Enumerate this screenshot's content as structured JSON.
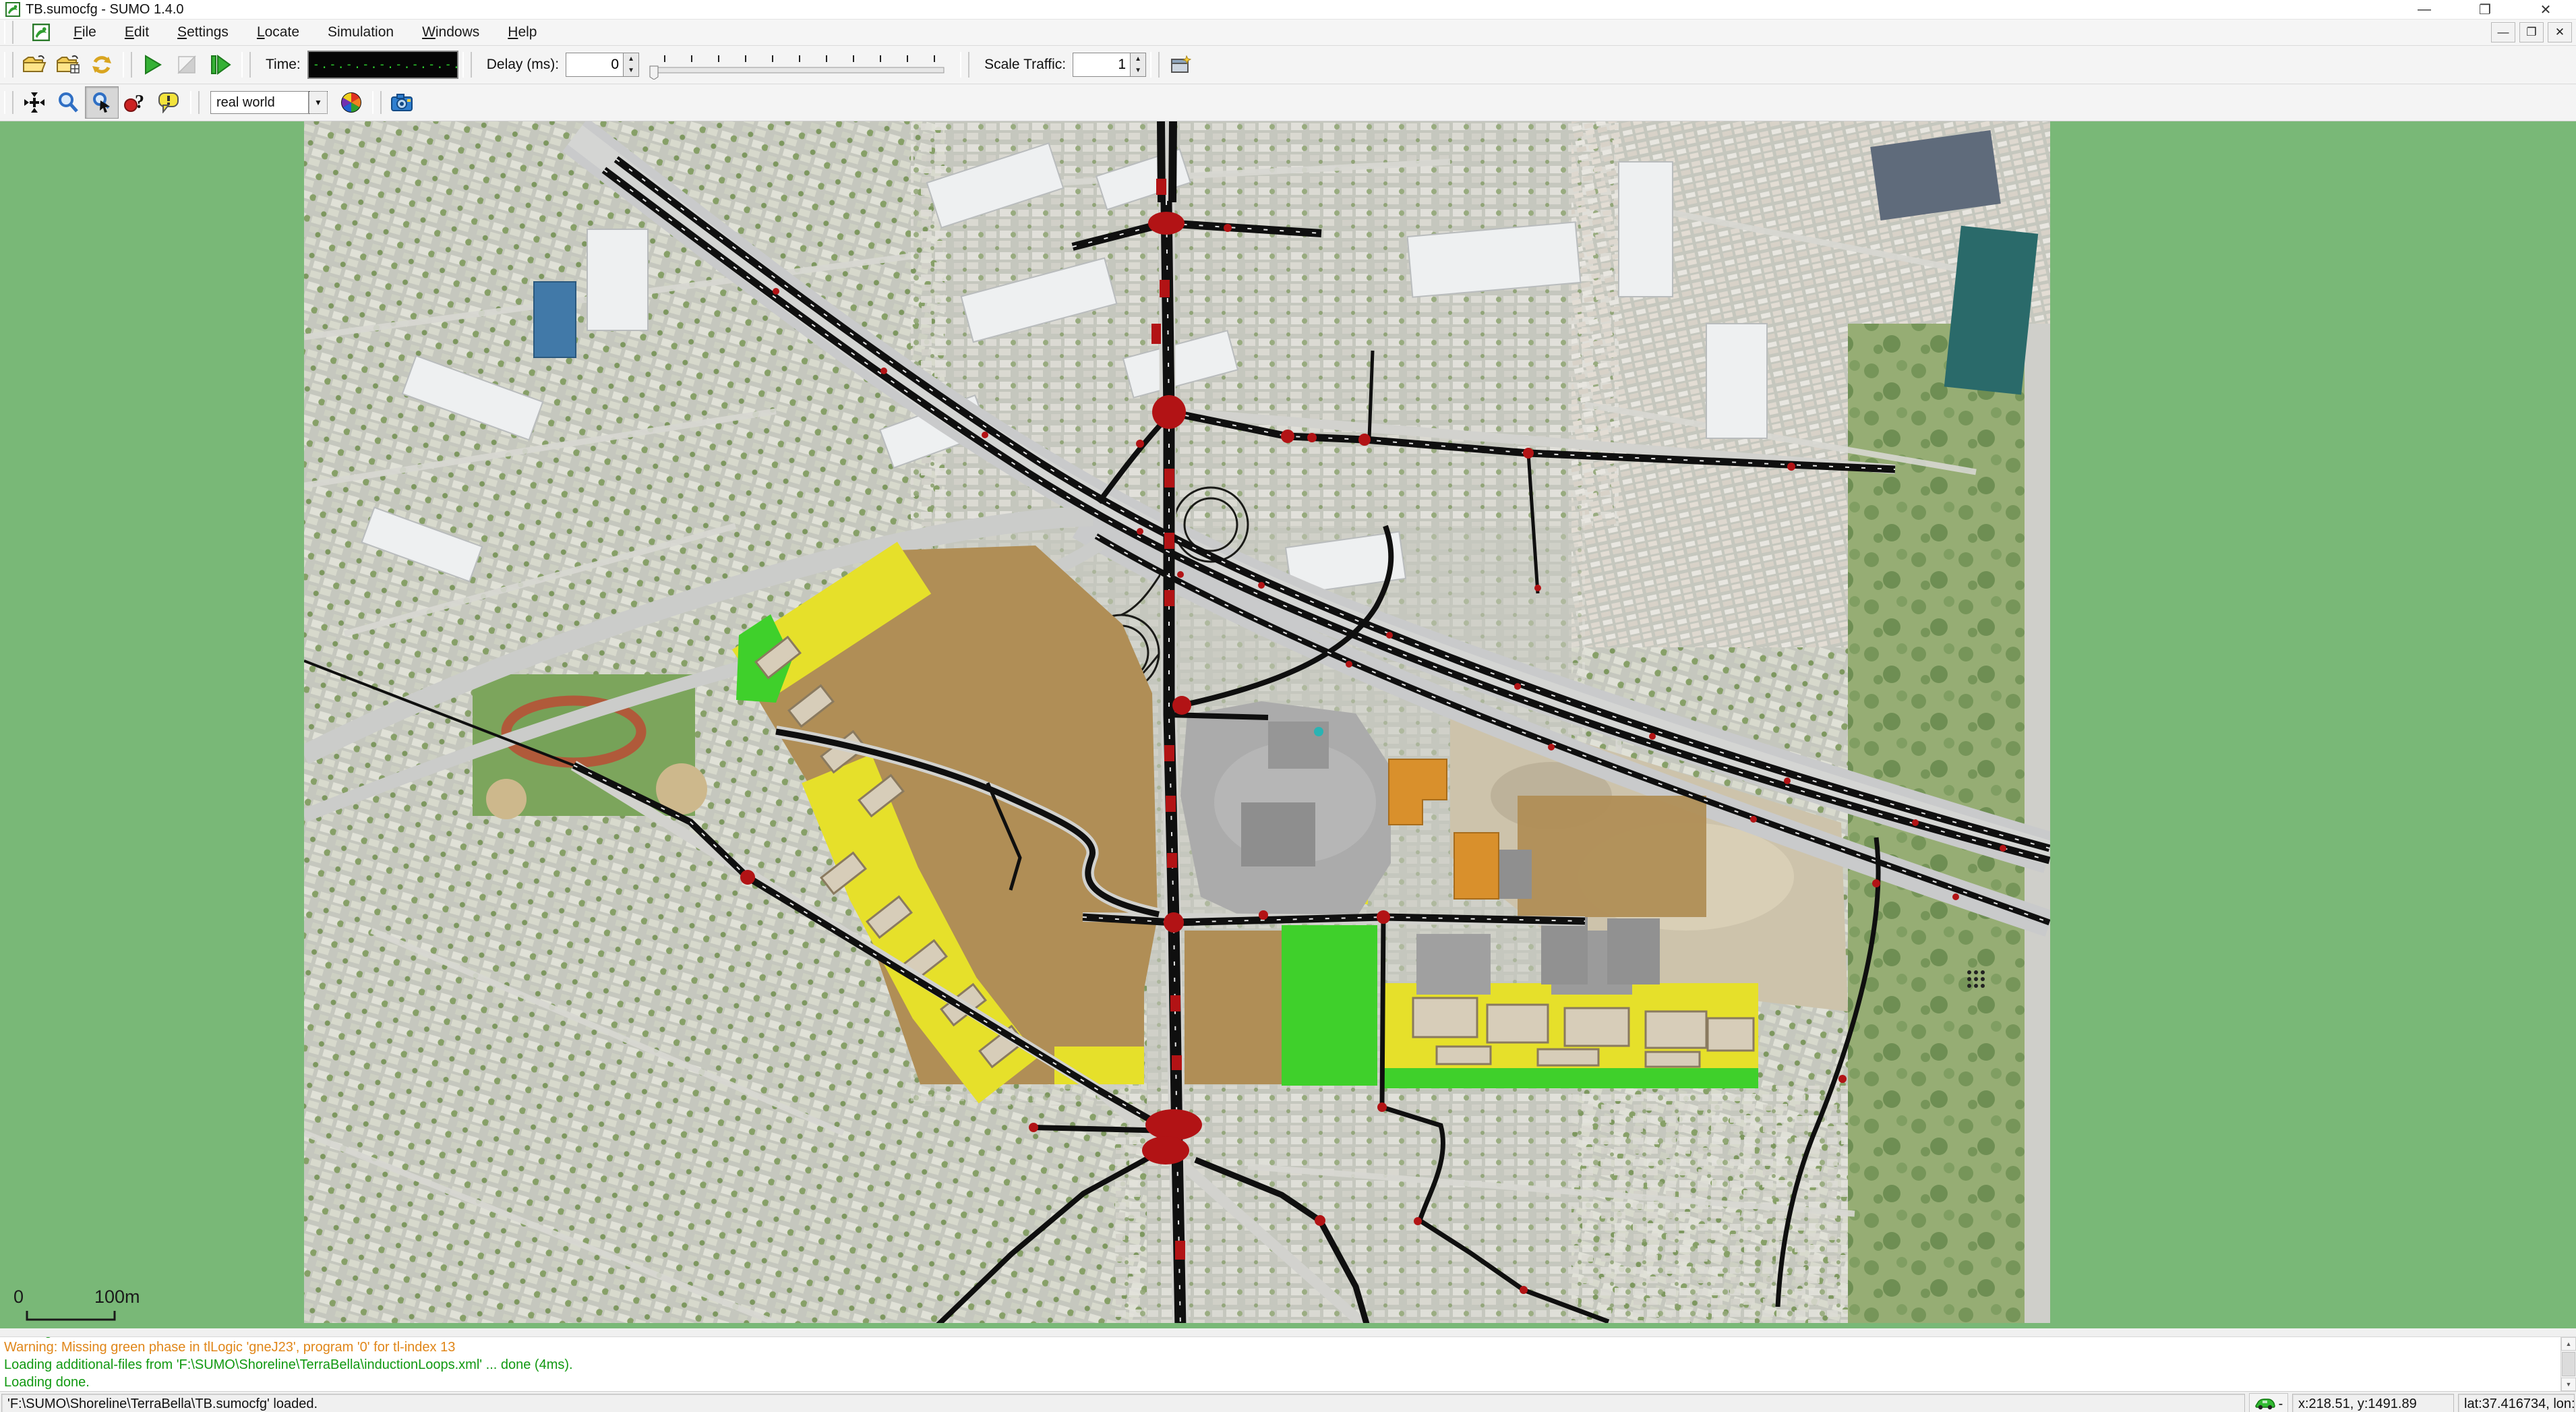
{
  "window": {
    "title": "TB.sumocfg - SUMO 1.4.0"
  },
  "menu": {
    "items": [
      {
        "label": "File"
      },
      {
        "label": "Edit"
      },
      {
        "label": "Settings"
      },
      {
        "label": "Locate"
      },
      {
        "label": "Simulation"
      },
      {
        "label": "Windows"
      },
      {
        "label": "Help"
      }
    ]
  },
  "toolbar": {
    "time_label": "Time:",
    "time_value": "-.-.-.-.-.-.-.-.-.-.-.-.-.-.-",
    "delay_label": "Delay (ms):",
    "delay_value": "0",
    "scale_label": "Scale Traffic:",
    "scale_value": "1"
  },
  "viewbar": {
    "coloring_value": "real world"
  },
  "map": {
    "scale_zero": "0",
    "scale_label": "100m"
  },
  "log": {
    "lines": [
      {
        "type": "warning",
        "text": "Warning: Missing green phase in tlLogic 'gneJ23', program '0' for tl-index 13"
      },
      {
        "type": "ok",
        "text": "Loading additional-files from 'F:\\SUMO\\Shoreline\\TerraBella\\inductionLoops.xml' ... done (4ms)."
      },
      {
        "type": "ok",
        "text": "Loading done."
      }
    ]
  },
  "statusbar": {
    "message": "'F:\\SUMO\\Shoreline\\TerraBella\\TB.sumocfg' loaded.",
    "car_suffix": "-",
    "xy": "x:218.51, y:1491.89",
    "latlon": "lat:37.416734, lon:-122.090"
  },
  "colors": {
    "background_green": "#79b877",
    "junction_red": "#b21315",
    "zone_brown": "#b08e56",
    "zone_yellow": "#e6e02a",
    "zone_green": "#3fd02b",
    "warning_orange": "#e08619",
    "ok_green": "#119911",
    "lcd_green": "#2fd42f"
  }
}
